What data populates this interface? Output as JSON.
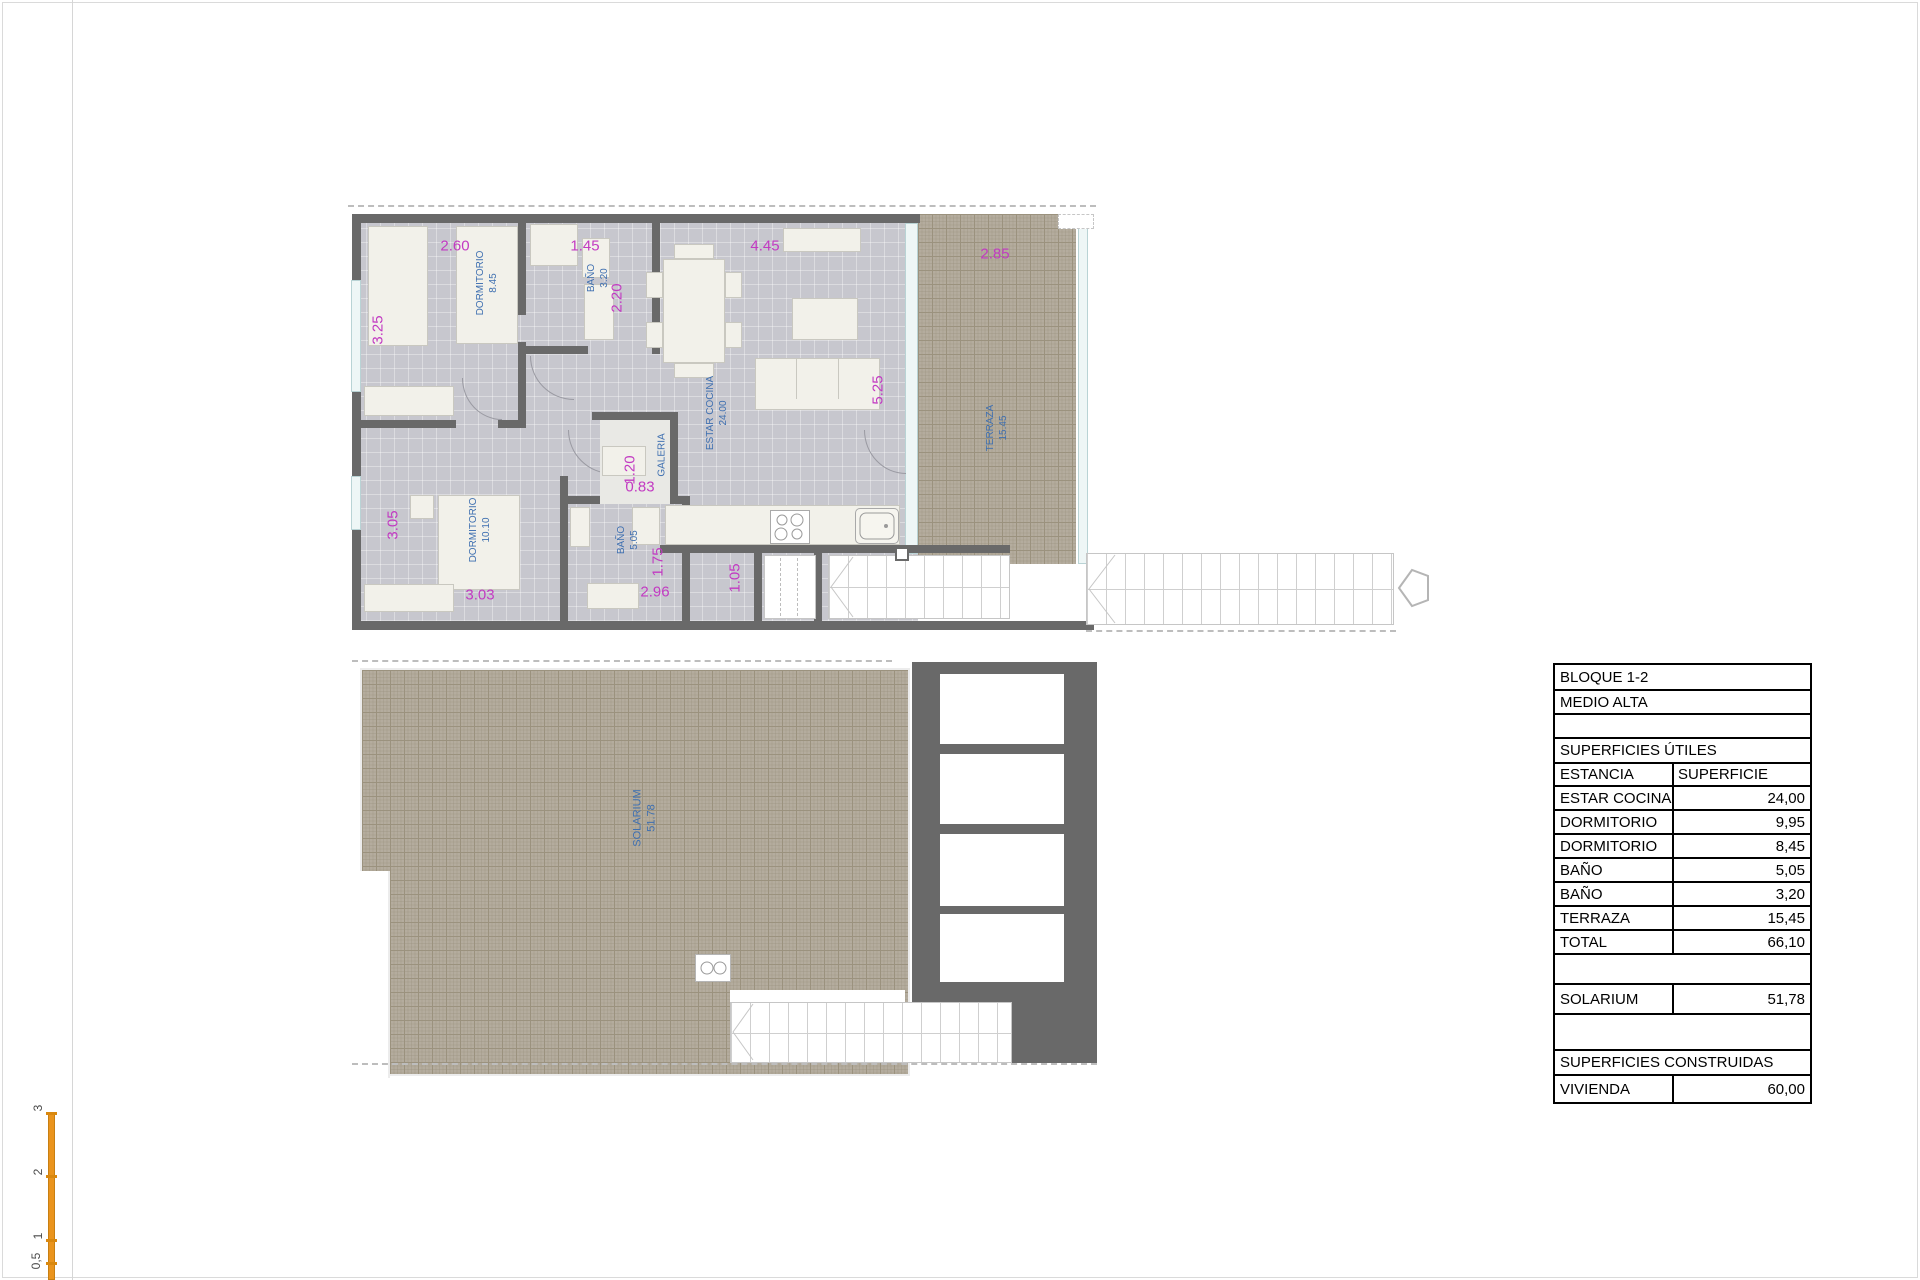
{
  "table": {
    "rows": [
      {
        "label": "BLOQUE 1-2",
        "value": ""
      },
      {
        "label": "MEDIO ALTA",
        "value": ""
      },
      {
        "label": "",
        "value": ""
      },
      {
        "label": "SUPERFICIES ÚTILES",
        "value": ""
      },
      {
        "label": "ESTANCIA",
        "value": "SUPERFICIE"
      },
      {
        "label": "ESTAR COCINA",
        "value": "24,00"
      },
      {
        "label": "DORMITORIO",
        "value": "9,95"
      },
      {
        "label": "DORMITORIO",
        "value": "8,45"
      },
      {
        "label": "BAÑO",
        "value": "5,05"
      },
      {
        "label": "BAÑO",
        "value": "3,20"
      },
      {
        "label": "TERRAZA",
        "value": "15,45"
      },
      {
        "label": "TOTAL",
        "value": "66,10"
      },
      {
        "label": "",
        "value": ""
      },
      {
        "label": "SOLARIUM",
        "value": "51,78"
      },
      {
        "label": "",
        "value": ""
      },
      {
        "label": "SUPERFICIES CONSTRUIDAS",
        "value": ""
      },
      {
        "label": "VIVIENDA",
        "value": "60,00"
      }
    ]
  },
  "upper": {
    "dims": {
      "d260": "2.60",
      "d145": "1.45",
      "d445": "4.45",
      "d285": "2.85",
      "d325": "3.25",
      "d220": "2.20",
      "d525": "5.25",
      "d120": "1.20",
      "d083": "0.83",
      "d305": "3.05",
      "d175": "1.75",
      "d105": "1.05",
      "d303": "3.03",
      "d296": "2.96"
    },
    "rooms": {
      "dorm1": {
        "name": "DORMITORIO",
        "area": "8.45"
      },
      "bano1": {
        "name": "BAÑO",
        "area": "3.20"
      },
      "estar": {
        "name": "ESTAR COCINA",
        "area": "24.00"
      },
      "terraza": {
        "name": "TERRAZA",
        "area": "15.45"
      },
      "galeria": {
        "name": "GALERIA",
        "area": ""
      },
      "dorm2": {
        "name": "DORMITORIO",
        "area": "10.10"
      },
      "bano2": {
        "name": "BAÑO",
        "area": "5.05"
      }
    }
  },
  "lower": {
    "rooms": {
      "solarium": {
        "name": "SOLARIUM",
        "area": "51.78"
      }
    }
  },
  "scalebar": {
    "labels": [
      "3",
      "2",
      "1",
      "0,5"
    ]
  }
}
